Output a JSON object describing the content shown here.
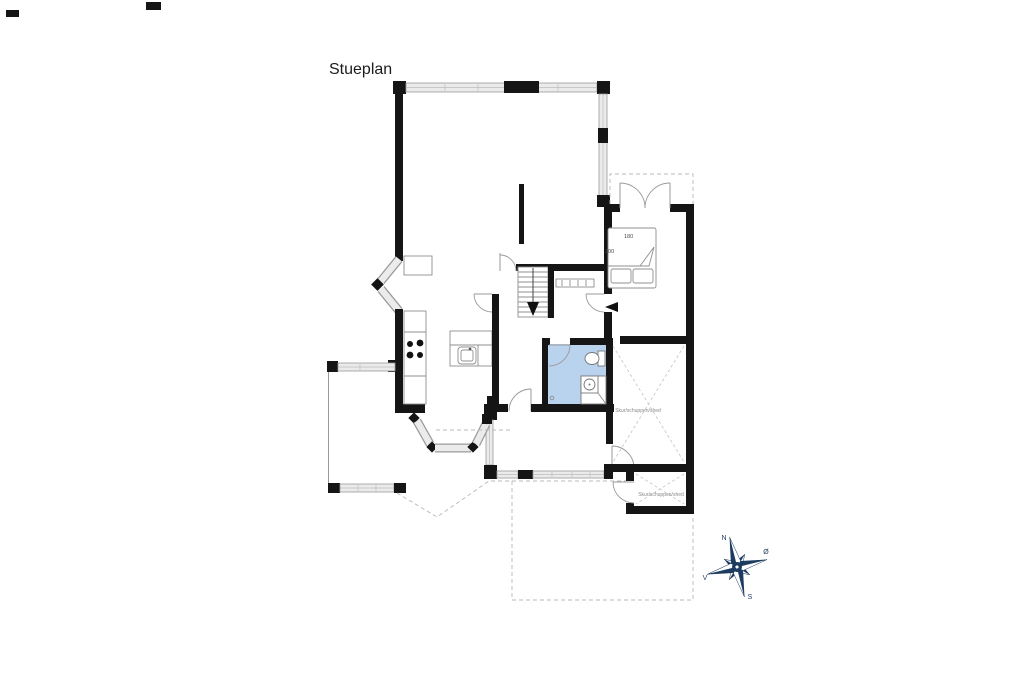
{
  "title": "Stueplan",
  "bed": {
    "width_label": "180",
    "length_label": "200"
  },
  "sheds": {
    "large_label": "Skur/schuppen/shed",
    "small_label": "Skur/schuppen/shed"
  },
  "compass": {
    "north": "N",
    "east": "Ø",
    "south": "S",
    "west": "V"
  },
  "colors": {
    "wall": "#151515",
    "win": "#ebebeb",
    "bath": "#b9d3ee",
    "dash": "#b8b8b8",
    "compass": "#1d3a5f",
    "ink": "#1c1c1c",
    "label": "#8a8a8a"
  }
}
